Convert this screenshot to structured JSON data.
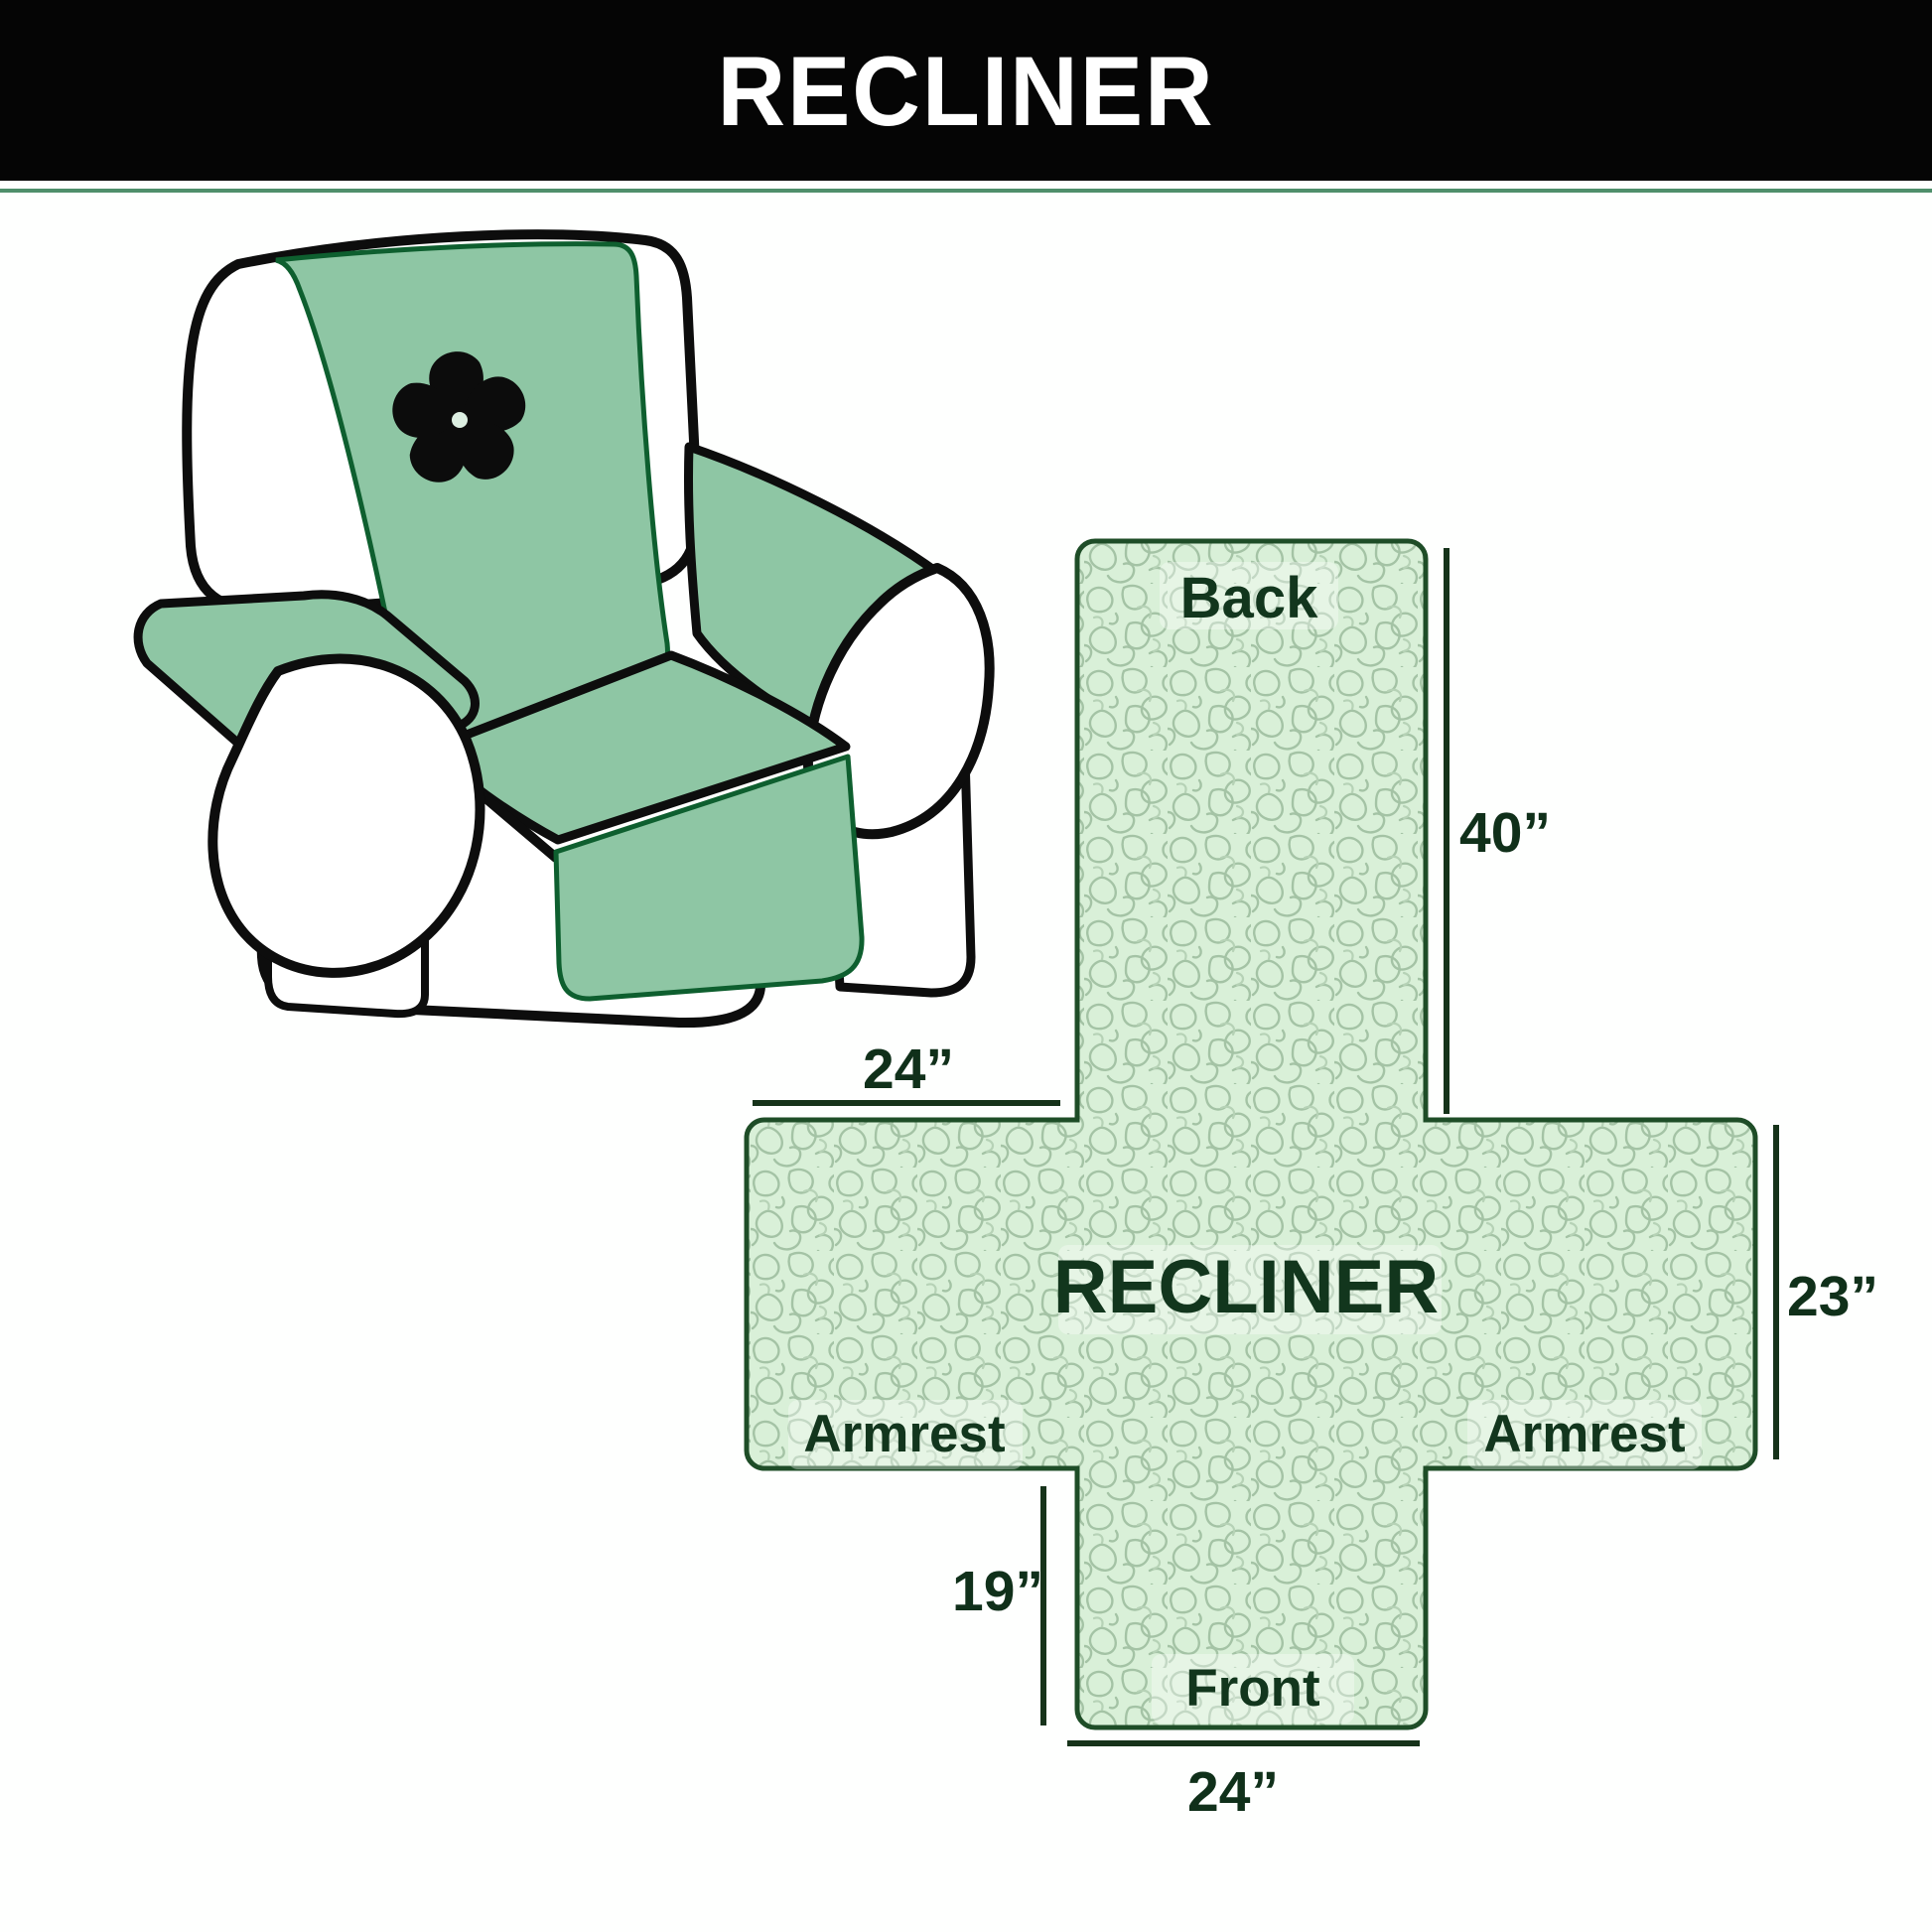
{
  "banner": {
    "title": "RECLINER"
  },
  "chair": {
    "illustration": "armchair-with-green-quilted-cover",
    "logo_icon": "pinwheel-fan-icon"
  },
  "diagram": {
    "center_label": "RECLINER",
    "back_label": "Back",
    "front_label": "Front",
    "armrest_left_label": "Armrest",
    "armrest_right_label": "Armrest",
    "dims": {
      "back_height": "40”",
      "armrest_top_width": "24”",
      "side_height": "23”",
      "front_height": "19”",
      "front_width": "24”"
    }
  },
  "colors": {
    "banner_bg": "#050505",
    "banner_text": "#ffffff",
    "cover_green": "#8ec6a4",
    "pattern_bg": "#d9f0d8",
    "pattern_squiggle": "#a4c3a5",
    "cross_outline": "#1e4d27",
    "label_text": "#12361d",
    "dim_line": "#16331a",
    "chair_outline": "#0d0d0d"
  }
}
